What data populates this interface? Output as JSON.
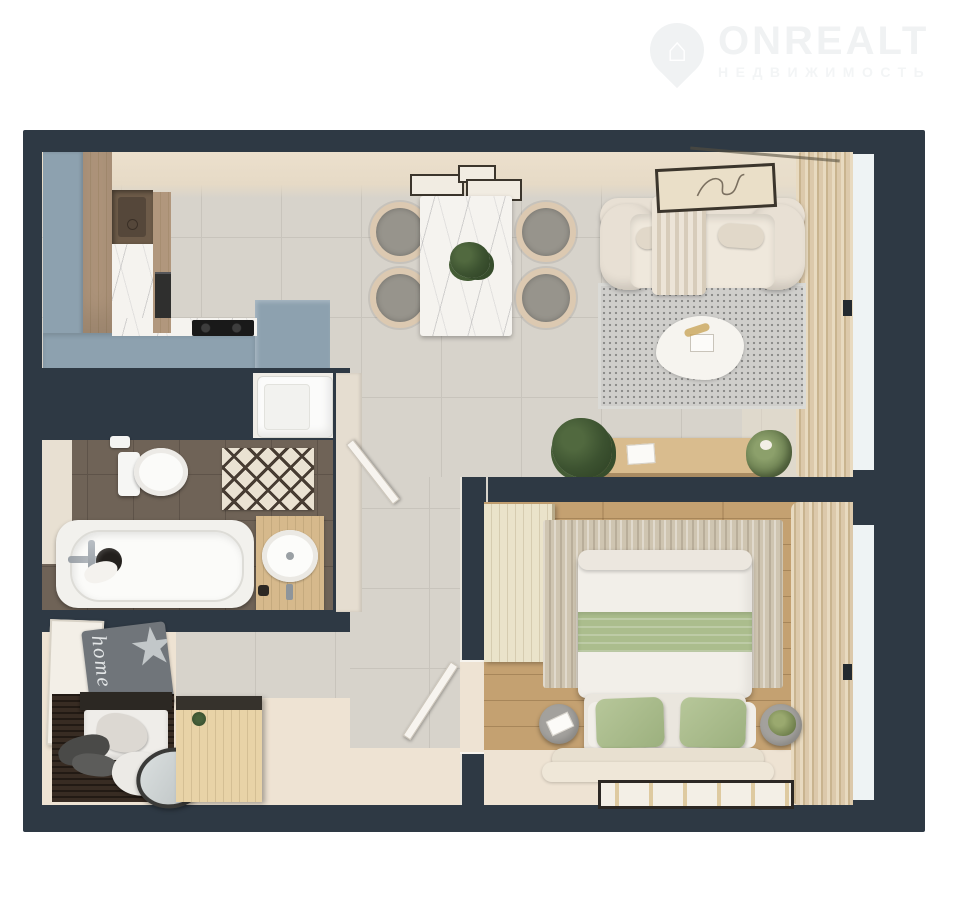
{
  "logo": {
    "title": "ONREALT",
    "subtitle": "НЕДВИЖИМОСТЬ",
    "icon": "house-pin-icon",
    "color": "#f0f2f3"
  },
  "floorplan": {
    "type": "apartment-top-view-3d-render",
    "doormat_text": "home"
  },
  "colors": {
    "wall": "#2e3944",
    "tile": "#d7d3cb",
    "tile_line": "#c8c4bc",
    "wall_face": "#e9ddcb",
    "floor_cream": "#eee3d3",
    "kitchen_blue": "#8da1af",
    "tan": "#b1977d",
    "wood_desk": "#d9bc8e",
    "light_wood": "#e8d3a7",
    "marble": "#f5f3ef",
    "brown_tile": "#6f6357",
    "brown_tile_line": "#5e5349",
    "bed_wood": "#c4a171",
    "sage": "#abbd8d",
    "boucle": "#e8e0d4",
    "rug": "#cfcecb",
    "rug_dot": "#8d8d8b",
    "jute": "#cfc5b1",
    "window": "#eef3f4",
    "dark": "#2d2823",
    "logo": "#f0f2f3",
    "logo_sub": "#f3f5f6"
  }
}
